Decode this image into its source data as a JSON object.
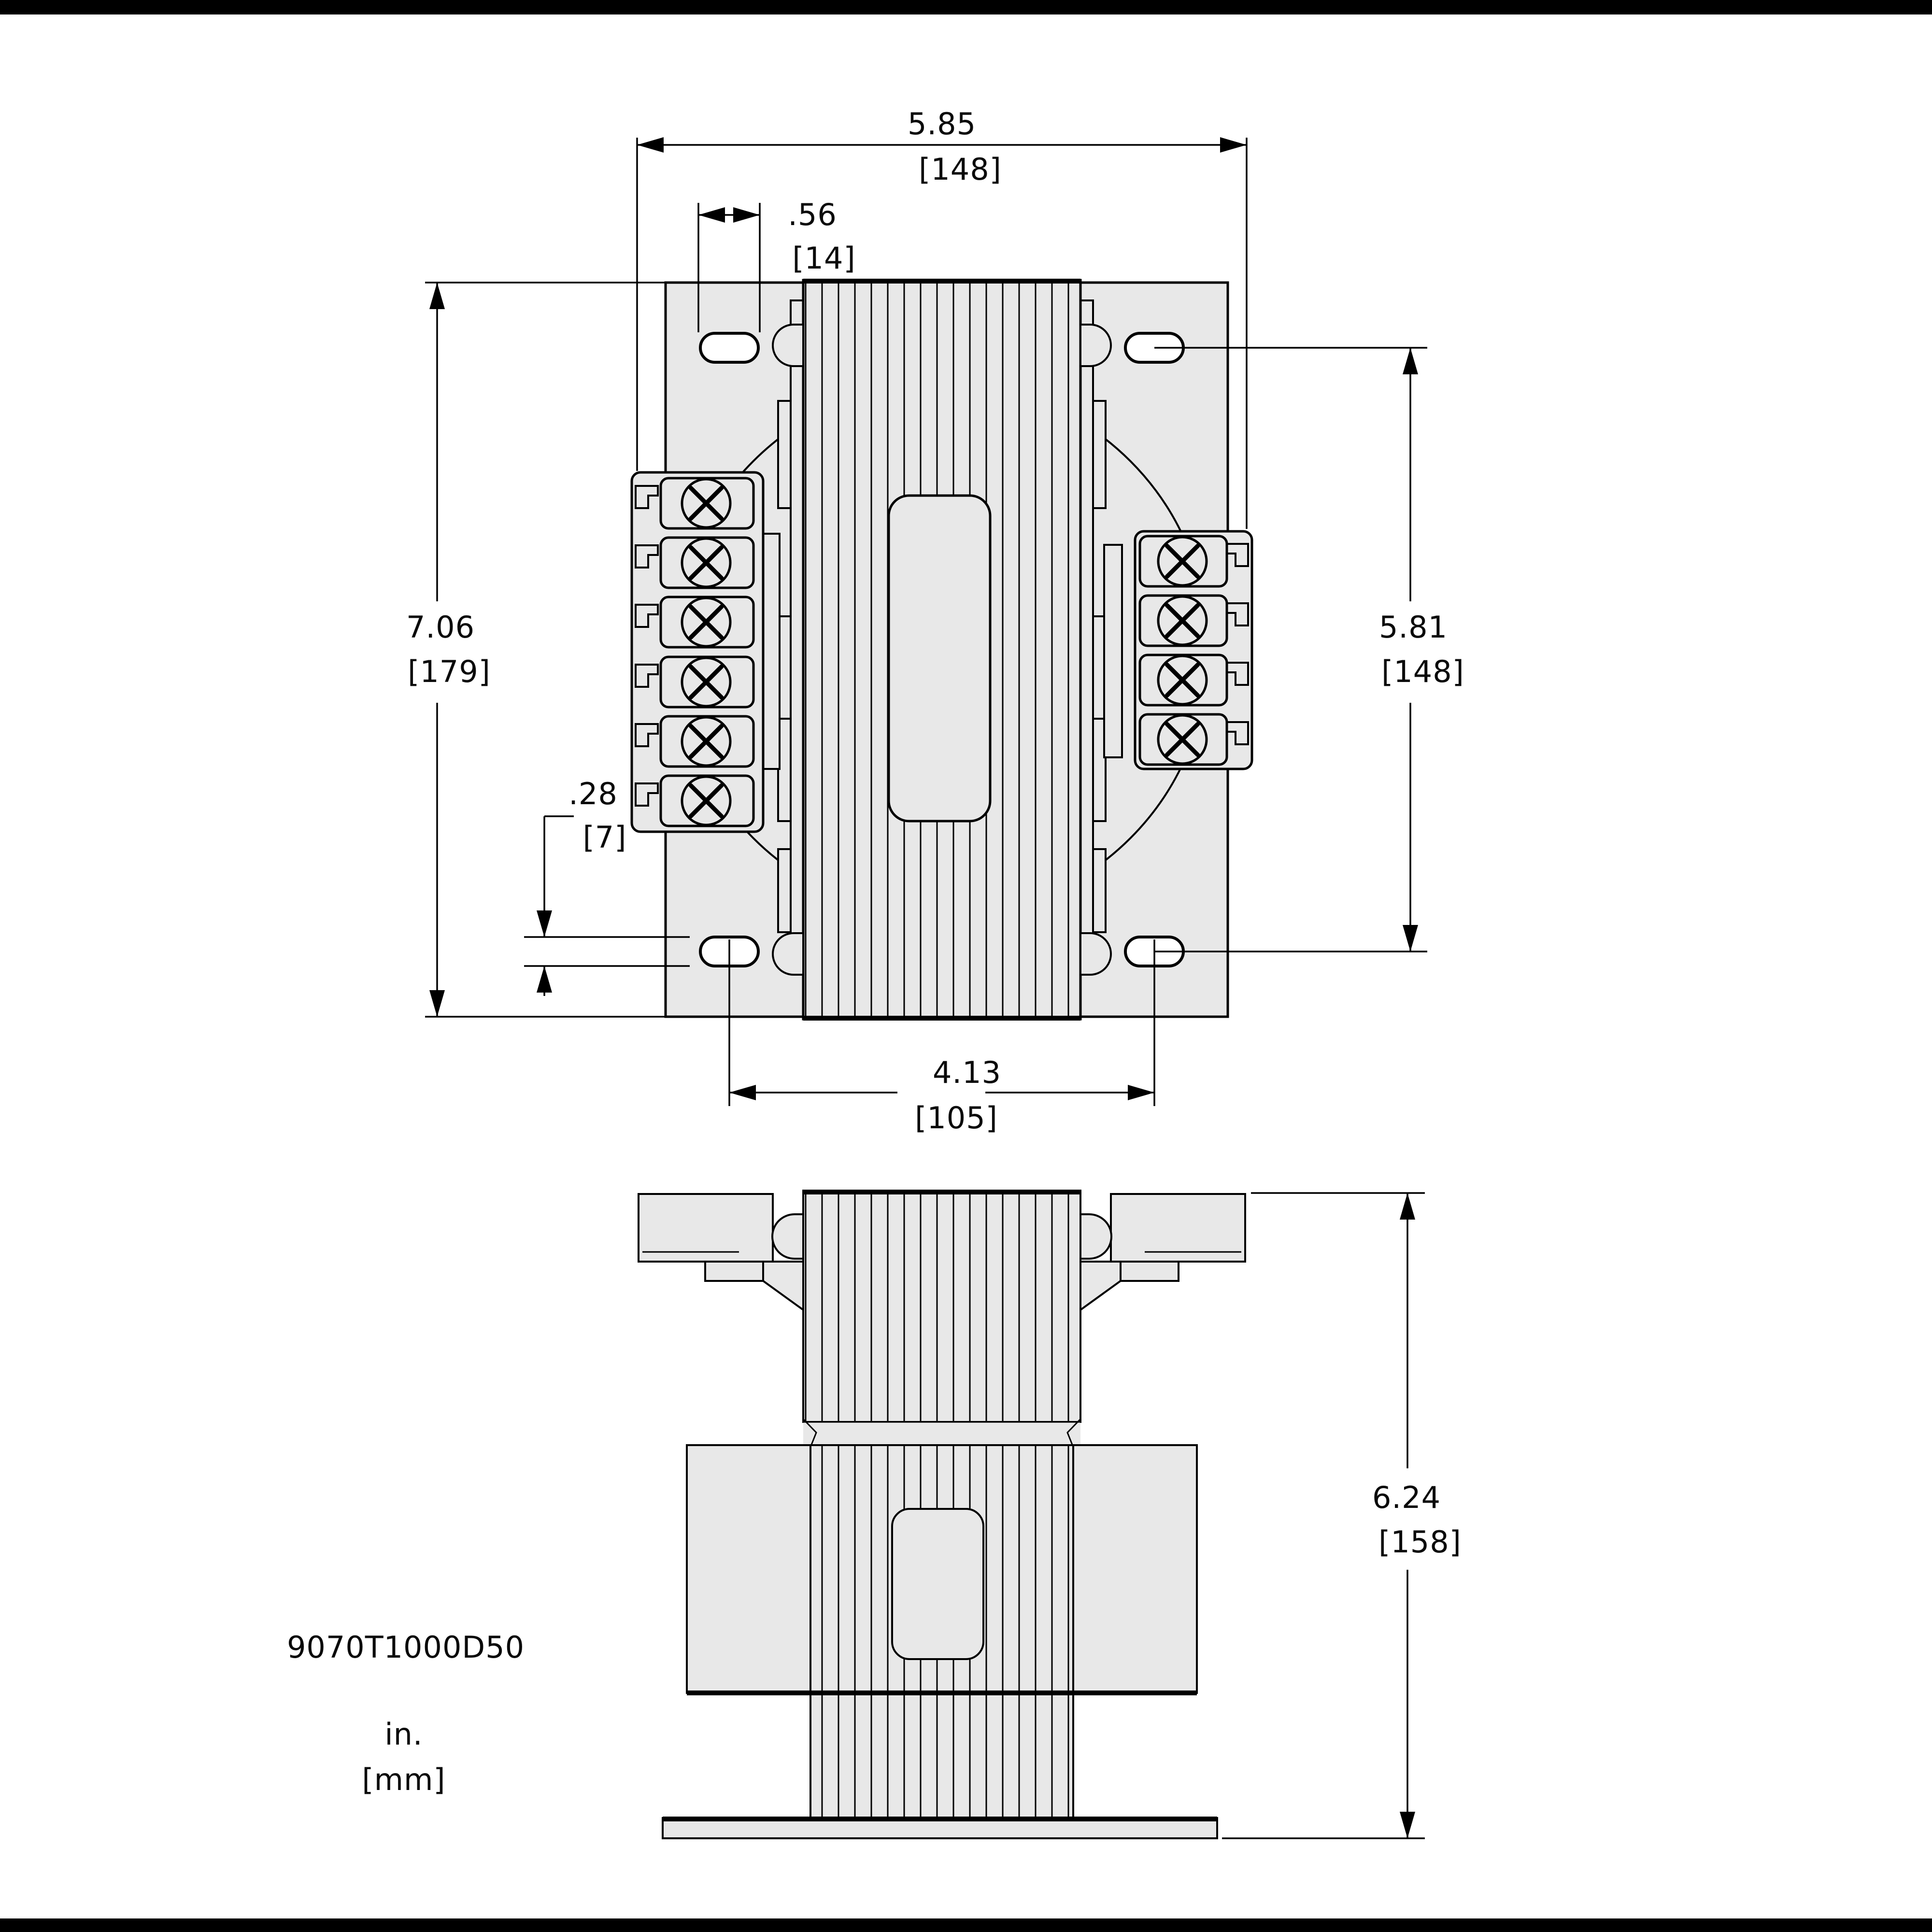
{
  "drawing": {
    "part_number": "9070T1000D50",
    "units_note": {
      "inches": "in.",
      "millimeters": "[mm]"
    },
    "dimensions": {
      "overall_width": {
        "in": "5.85",
        "mm": "[148]"
      },
      "slot_length": {
        "in": ".56",
        "mm": "[14]"
      },
      "overall_height": {
        "in": "7.06",
        "mm": "[179]"
      },
      "slot_vertical_spacing": {
        "in": "5.81",
        "mm": "[148]"
      },
      "slot_width": {
        "in": ".28",
        "mm": "[7]"
      },
      "slot_horizontal_spacing": {
        "in": "4.13",
        "mm": "[105]"
      },
      "side_overall_height": {
        "in": "6.24",
        "mm": "[158]"
      }
    }
  }
}
